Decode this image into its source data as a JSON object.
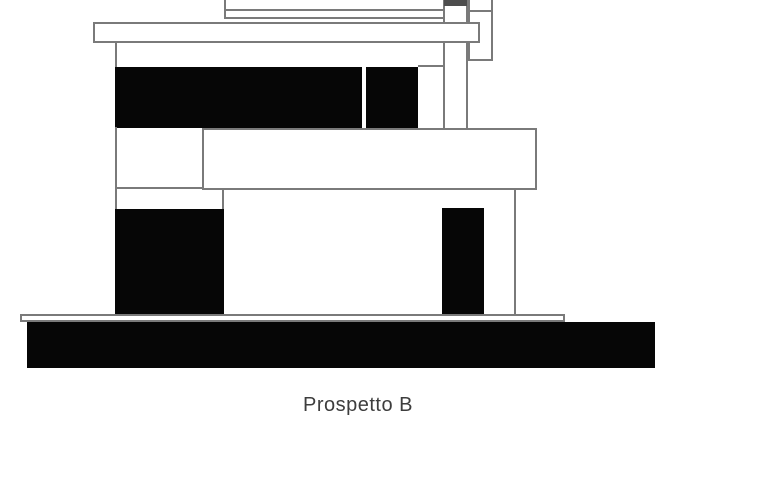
{
  "title": {
    "text": "Prospetto B"
  },
  "drawing": {
    "name": "building-elevation-b",
    "type": "architectural-elevation",
    "colors": {
      "line": "#7a7a7a",
      "fill_black": "#060606",
      "fill_white": "#ffffff",
      "cap_gray": "#4d4d4d",
      "text": "#3d3d3d",
      "background": "#ffffff"
    }
  }
}
